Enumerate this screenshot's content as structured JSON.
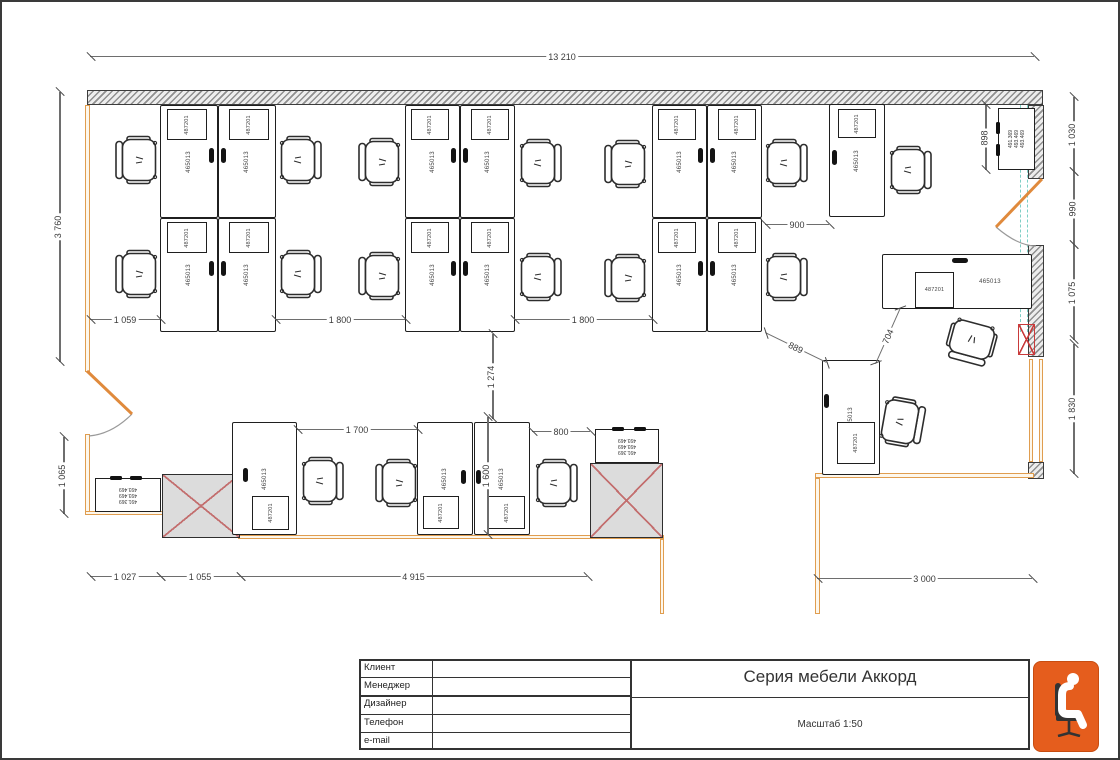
{
  "labels": {
    "desk": "465013",
    "pedestal": "487201",
    "cabinet_lines": [
      "491.369",
      "493.469",
      "493.469"
    ]
  },
  "title_block": {
    "rows": [
      {
        "label": "Клиент",
        "value": ""
      },
      {
        "label": "Менеджер",
        "value": ""
      },
      {
        "label": "Дизайнер",
        "value": ""
      },
      {
        "label": "Телефон",
        "value": ""
      },
      {
        "label": "e-mail",
        "value": ""
      }
    ],
    "title": "Серия мебели Аккорд",
    "scale": "Масштаб 1:50"
  },
  "colors": {
    "wall_orange": "#e09d4f",
    "window_teal": "#7ecfc6",
    "column_x": "#c36f6f",
    "red": "#c93b3b",
    "logo_orange": "#e55d1d"
  },
  "plan": {
    "walls_hatched": [
      {
        "x": 85,
        "y": 88,
        "w": 956,
        "h": 15
      },
      {
        "x": 1026,
        "y": 103,
        "w": 16,
        "h": 74
      },
      {
        "x": 1026,
        "y": 243,
        "w": 16,
        "h": 112
      },
      {
        "x": 1026,
        "y": 460,
        "w": 16,
        "h": 17
      }
    ],
    "walls_orange": [
      {
        "x": 83,
        "y": 103,
        "w": 5,
        "h": 267
      },
      {
        "x": 83,
        "y": 432,
        "w": 5,
        "h": 80
      },
      {
        "x": 83,
        "y": 509,
        "w": 80,
        "h": 4
      },
      {
        "x": 236,
        "y": 533,
        "w": 426,
        "h": 4
      },
      {
        "x": 658,
        "y": 537,
        "w": 4,
        "h": 75
      },
      {
        "x": 813,
        "y": 471,
        "w": 219,
        "h": 5
      },
      {
        "x": 813,
        "y": 476,
        "w": 5,
        "h": 136
      },
      {
        "x": 1027,
        "y": 357,
        "w": 4,
        "h": 103
      },
      {
        "x": 1037,
        "y": 357,
        "w": 4,
        "h": 103
      }
    ],
    "windows_teal": [
      {
        "x": 1018,
        "y": 103,
        "w": 8,
        "h": 227
      }
    ],
    "doors": [
      {
        "type": "left",
        "x": 80,
        "y": 366
      },
      {
        "type": "right",
        "x": 986,
        "y": 173
      }
    ],
    "columns": [
      {
        "x": 160,
        "y": 472,
        "w": 78,
        "h": 64
      },
      {
        "x": 588,
        "y": 461,
        "w": 73,
        "h": 75
      }
    ],
    "red_boxes": [
      {
        "x": 1016,
        "y": 322,
        "w": 17,
        "h": 31
      }
    ],
    "cabinets": [
      {
        "x": 93,
        "y": 476,
        "w": 66,
        "h": 34,
        "r": 180,
        "pills": [
          [
            108,
            474,
            12,
            4
          ],
          [
            128,
            474,
            12,
            4
          ]
        ]
      },
      {
        "x": 593,
        "y": 427,
        "w": 64,
        "h": 34,
        "r": 180,
        "pills": [
          [
            610,
            425,
            12,
            4
          ],
          [
            632,
            425,
            12,
            4
          ]
        ]
      },
      {
        "x": 996,
        "y": 106,
        "w": 37,
        "h": 62,
        "r": -90,
        "pills": [
          [
            994,
            120,
            4,
            12
          ],
          [
            994,
            142,
            4,
            12
          ]
        ]
      }
    ],
    "desks": [
      {
        "x": 158,
        "y": 103,
        "w": 58,
        "h": 113,
        "r": -90,
        "ped": [
          165,
          107,
          40,
          31
        ],
        "pr": -90,
        "g": [
          [
            207,
            146,
            5,
            15
          ]
        ]
      },
      {
        "x": 216,
        "y": 103,
        "w": 58,
        "h": 113,
        "r": -90,
        "ped": [
          227,
          107,
          40,
          31
        ],
        "pr": -90,
        "g": [
          [
            219,
            146,
            5,
            15
          ]
        ]
      },
      {
        "x": 158,
        "y": 216,
        "w": 58,
        "h": 114,
        "r": -90,
        "ped": [
          165,
          220,
          40,
          31
        ],
        "pr": -90,
        "g": [
          [
            207,
            259,
            5,
            15
          ]
        ]
      },
      {
        "x": 216,
        "y": 216,
        "w": 58,
        "h": 114,
        "r": -90,
        "ped": [
          227,
          220,
          40,
          31
        ],
        "pr": -90,
        "g": [
          [
            219,
            259,
            5,
            15
          ]
        ]
      },
      {
        "x": 403,
        "y": 103,
        "w": 55,
        "h": 113,
        "r": -90,
        "ped": [
          409,
          107,
          38,
          31
        ],
        "pr": -90,
        "g": [
          [
            449,
            146,
            5,
            15
          ]
        ]
      },
      {
        "x": 458,
        "y": 103,
        "w": 55,
        "h": 113,
        "r": -90,
        "ped": [
          469,
          107,
          38,
          31
        ],
        "pr": -90,
        "g": [
          [
            461,
            146,
            5,
            15
          ]
        ]
      },
      {
        "x": 403,
        "y": 216,
        "w": 55,
        "h": 114,
        "r": -90,
        "ped": [
          409,
          220,
          38,
          31
        ],
        "pr": -90,
        "g": [
          [
            449,
            259,
            5,
            15
          ]
        ]
      },
      {
        "x": 458,
        "y": 216,
        "w": 55,
        "h": 114,
        "r": -90,
        "ped": [
          469,
          220,
          38,
          31
        ],
        "pr": -90,
        "g": [
          [
            461,
            259,
            5,
            15
          ]
        ]
      },
      {
        "x": 650,
        "y": 103,
        "w": 55,
        "h": 113,
        "r": -90,
        "ped": [
          656,
          107,
          38,
          31
        ],
        "pr": -90,
        "g": [
          [
            696,
            146,
            5,
            15
          ]
        ]
      },
      {
        "x": 705,
        "y": 103,
        "w": 55,
        "h": 113,
        "r": -90,
        "ped": [
          716,
          107,
          38,
          31
        ],
        "pr": -90,
        "g": [
          [
            708,
            146,
            5,
            15
          ]
        ]
      },
      {
        "x": 650,
        "y": 216,
        "w": 55,
        "h": 114,
        "r": -90,
        "ped": [
          656,
          220,
          38,
          31
        ],
        "pr": -90,
        "g": [
          [
            696,
            259,
            5,
            15
          ]
        ]
      },
      {
        "x": 705,
        "y": 216,
        "w": 55,
        "h": 114,
        "r": -90,
        "ped": [
          716,
          220,
          38,
          31
        ],
        "pr": -90,
        "g": [
          [
            708,
            259,
            5,
            15
          ]
        ]
      },
      {
        "x": 827,
        "y": 102,
        "w": 56,
        "h": 113,
        "r": -90,
        "ped": [
          836,
          107,
          38,
          29
        ],
        "pr": -90,
        "g": [
          [
            830,
            148,
            5,
            15
          ]
        ]
      },
      {
        "x": 230,
        "y": 420,
        "w": 65,
        "h": 113,
        "r": -90,
        "ped": [
          250,
          494,
          37,
          34
        ],
        "pr": -90,
        "g": [
          [
            241,
            466,
            5,
            14
          ]
        ]
      },
      {
        "x": 415,
        "y": 420,
        "w": 56,
        "h": 113,
        "r": -90,
        "ped": [
          421,
          494,
          36,
          33
        ],
        "pr": -90,
        "g": [
          [
            459,
            468,
            5,
            14
          ]
        ]
      },
      {
        "x": 472,
        "y": 420,
        "w": 56,
        "h": 113,
        "r": -90,
        "ped": [
          486,
          494,
          37,
          33
        ],
        "pr": -90,
        "g": [
          [
            474,
            468,
            5,
            14
          ]
        ]
      },
      {
        "x": 820,
        "y": 358,
        "w": 58,
        "h": 115,
        "r": -90,
        "ped": [
          835,
          420,
          38,
          42
        ],
        "pr": -90,
        "g": [
          [
            822,
            392,
            5,
            14
          ]
        ]
      },
      {
        "x": 880,
        "y": 252,
        "w": 150,
        "h": 55,
        "r": 0,
        "lx": 0.72,
        "ped": [
          913,
          270,
          39,
          36
        ],
        "pr": 0,
        "g": [
          [
            950,
            256,
            16,
            5
          ]
        ]
      }
    ],
    "chairs": [
      [
        112,
        133,
        0
      ],
      [
        112,
        247,
        0
      ],
      [
        274,
        133,
        180
      ],
      [
        274,
        247,
        180
      ],
      [
        355,
        135,
        0
      ],
      [
        355,
        249,
        0
      ],
      [
        514,
        136,
        180
      ],
      [
        514,
        250,
        180
      ],
      [
        601,
        137,
        0
      ],
      [
        601,
        251,
        0
      ],
      [
        760,
        136,
        180
      ],
      [
        760,
        250,
        180
      ],
      [
        884,
        143,
        180
      ],
      [
        946,
        314,
        -75
      ],
      [
        876,
        395,
        190
      ],
      [
        296,
        454,
        180
      ],
      [
        372,
        456,
        0
      ],
      [
        530,
        456,
        180
      ]
    ],
    "dims": [
      {
        "t": "13 210",
        "o": "h",
        "x": 88,
        "y": 55,
        "len": 944
      },
      {
        "t": "1 059",
        "o": "h",
        "x": 88,
        "y": 318,
        "len": 70
      },
      {
        "t": "1 800",
        "o": "h",
        "x": 273,
        "y": 318,
        "len": 130
      },
      {
        "t": "1 800",
        "o": "h",
        "x": 512,
        "y": 318,
        "len": 138
      },
      {
        "t": "900",
        "o": "h",
        "x": 763,
        "y": 223,
        "len": 64
      },
      {
        "t": "1 700",
        "o": "h",
        "x": 295,
        "y": 428,
        "len": 120
      },
      {
        "t": "800",
        "o": "h",
        "x": 530,
        "y": 430,
        "len": 58
      },
      {
        "t": "1 027",
        "o": "h",
        "x": 88,
        "y": 575,
        "len": 70
      },
      {
        "t": "1 055",
        "o": "h",
        "x": 158,
        "y": 575,
        "len": 80
      },
      {
        "t": "4 915",
        "o": "h",
        "x": 238,
        "y": 575,
        "len": 347
      },
      {
        "t": "3 000",
        "o": "h",
        "x": 815,
        "y": 577,
        "len": 215
      },
      {
        "t": "3 760",
        "o": "v",
        "x": 58,
        "y": 90,
        "len": 270
      },
      {
        "t": "898",
        "o": "v",
        "x": 984,
        "y": 103,
        "len": 65
      },
      {
        "t": "1 030",
        "o": "v",
        "x": 1072,
        "y": 95,
        "len": 75
      },
      {
        "t": "990",
        "o": "v",
        "x": 1072,
        "y": 170,
        "len": 73
      },
      {
        "t": "1 075",
        "o": "v",
        "x": 1072,
        "y": 243,
        "len": 95
      },
      {
        "t": "1 830",
        "o": "v",
        "x": 1072,
        "y": 342,
        "len": 130
      },
      {
        "t": "1 274",
        "o": "v",
        "x": 491,
        "y": 332,
        "len": 85
      },
      {
        "t": "1 600",
        "o": "v",
        "x": 486,
        "y": 415,
        "len": 118
      },
      {
        "t": "1 065",
        "o": "v",
        "x": 62,
        "y": 435,
        "len": 77
      },
      {
        "t": "889",
        "o": "d",
        "x": 763,
        "y": 331,
        "len": 68,
        "rot": 26
      },
      {
        "t": "704",
        "o": "d",
        "x": 874,
        "y": 362,
        "len": 60,
        "rot": -66
      }
    ]
  }
}
